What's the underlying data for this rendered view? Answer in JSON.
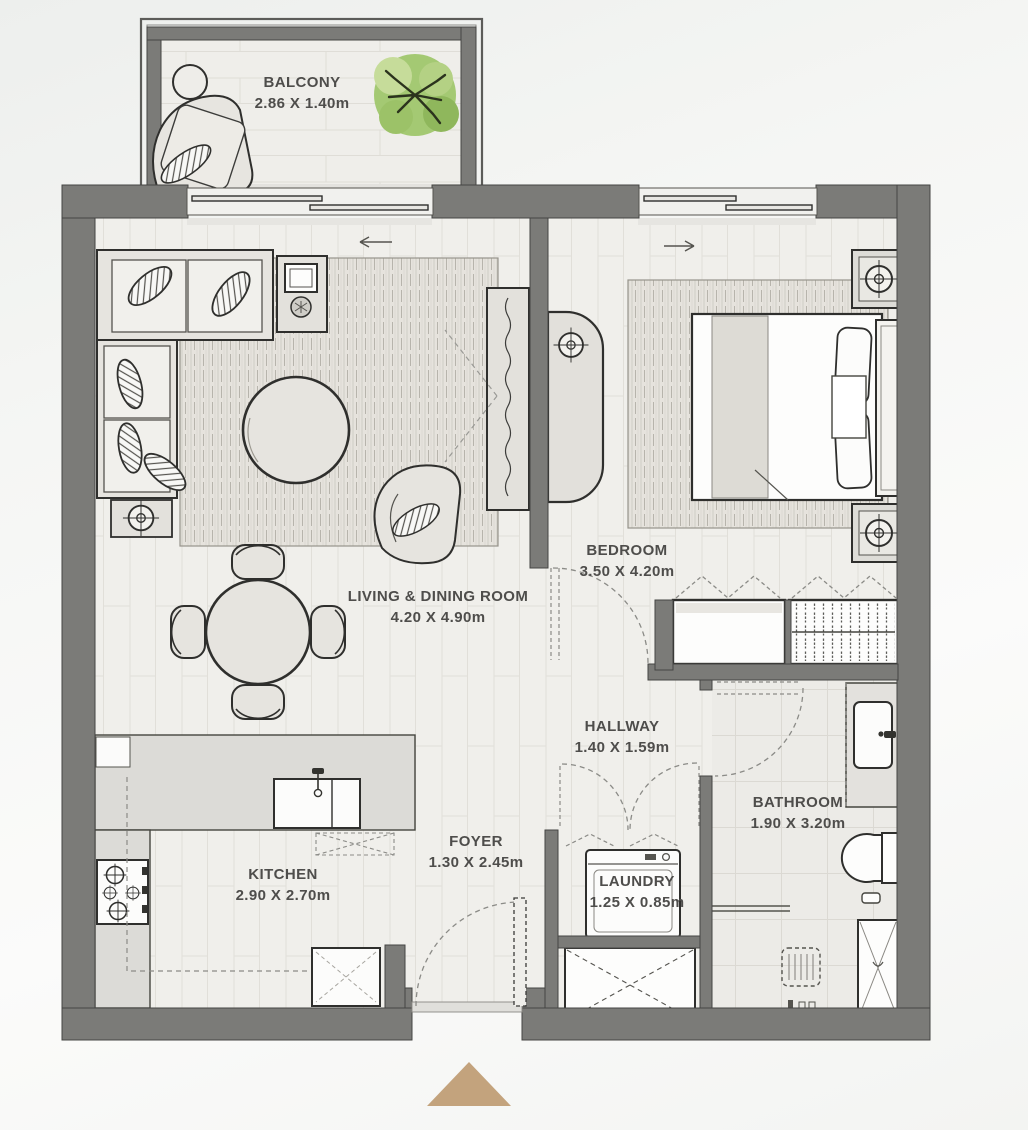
{
  "floorplan": {
    "title": "one-bedroom apartment floor plan",
    "rooms": [
      {
        "id": "balcony",
        "name": "BALCONY",
        "dimensions": "2.86 X 1.40m"
      },
      {
        "id": "living_dining",
        "name": "LIVING & DINING ROOM",
        "dimensions": "4.20 X 4.90m"
      },
      {
        "id": "bedroom",
        "name": "BEDROOM",
        "dimensions": "3.50 X 4.20m"
      },
      {
        "id": "hallway",
        "name": "HALLWAY",
        "dimensions": "1.40 X 1.59m"
      },
      {
        "id": "foyer",
        "name": "FOYER",
        "dimensions": "1.30 X 2.45m"
      },
      {
        "id": "kitchen",
        "name": "KITCHEN",
        "dimensions": "2.90 X 2.70m"
      },
      {
        "id": "laundry",
        "name": "LAUNDRY",
        "dimensions": "1.25 X 0.85m"
      },
      {
        "id": "bathroom",
        "name": "BATHROOM",
        "dimensions": "1.90 X 3.20m"
      }
    ],
    "colors": {
      "wall": "#7b7b78",
      "wall_edge": "#454543",
      "floor_plank": "#f0efeb",
      "floor_tile": "#ecebe7",
      "counter": "#dcdbd7",
      "furniture_fill": "#e6e4df",
      "furniture_stroke": "#2f2f2d",
      "rug_base": "#e6e3dd",
      "tree_green": "#a4c973",
      "label_text": "#4e4d4b",
      "entrance_marker": "#c3a37d"
    }
  }
}
